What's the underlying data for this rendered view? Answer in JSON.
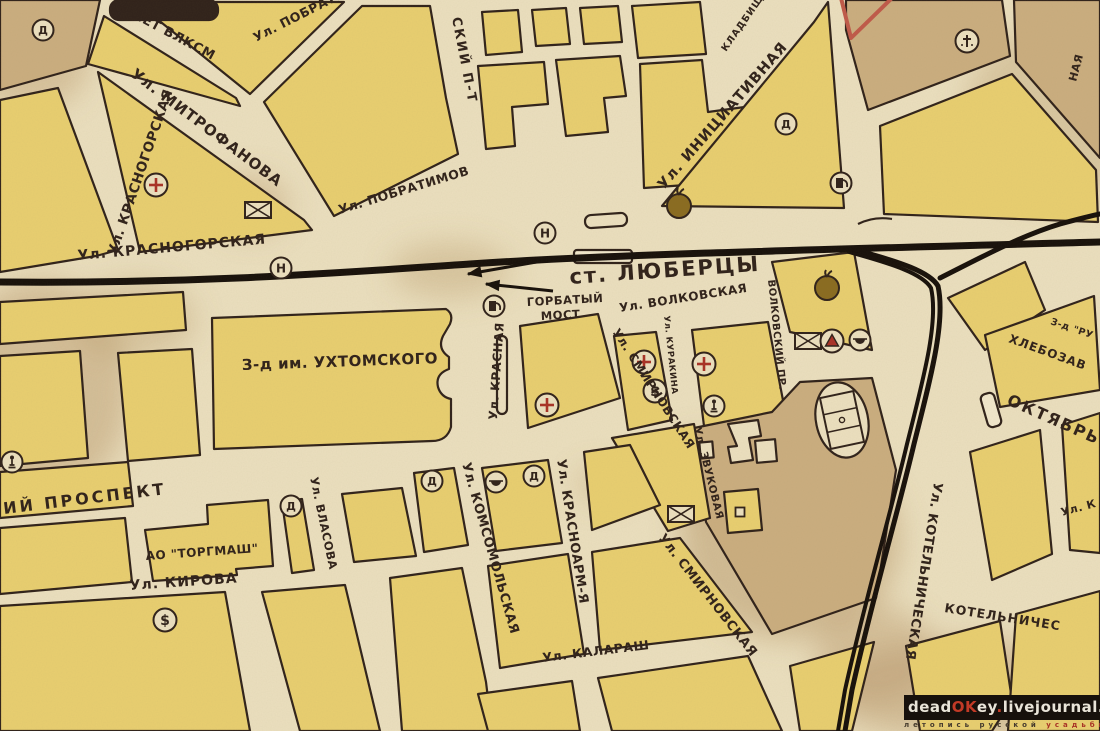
{
  "map": {
    "palette": {
      "paper": "#ece0bf",
      "paper_light": "#f2e8cc",
      "yellow": "#e9cf70",
      "tan": "#cbae7f",
      "ink": "#30221a",
      "rail": "#17100a",
      "red": "#a93226",
      "red_line": "#c05a49",
      "tomato": "#8a6c20",
      "stain": "#b89768"
    },
    "stains": [
      {
        "cx": 40,
        "cy": 390,
        "rx": 90,
        "ry": 110,
        "o": 0.45
      },
      {
        "cx": 250,
        "cy": 205,
        "rx": 38,
        "ry": 30,
        "o": 0.4
      },
      {
        "cx": 450,
        "cy": 270,
        "rx": 60,
        "ry": 28,
        "o": 0.35
      },
      {
        "cx": 790,
        "cy": 540,
        "rx": 110,
        "ry": 100,
        "o": 0.5
      },
      {
        "cx": 700,
        "cy": 475,
        "rx": 35,
        "ry": 40,
        "o": 0.4
      },
      {
        "cx": 960,
        "cy": 690,
        "rx": 140,
        "ry": 50,
        "o": 0.45
      },
      {
        "cx": 1055,
        "cy": 115,
        "rx": 90,
        "ry": 90,
        "o": 0.35
      },
      {
        "cx": 600,
        "cy": 485,
        "rx": 25,
        "ry": 18,
        "o": 0.3
      },
      {
        "cx": 135,
        "cy": 320,
        "rx": 60,
        "ry": 40,
        "o": 0.35
      },
      {
        "cx": 30,
        "cy": 60,
        "rx": 60,
        "ry": 50,
        "o": 0.4
      },
      {
        "cx": 875,
        "cy": 655,
        "rx": 60,
        "ry": 50,
        "o": 0.4
      }
    ],
    "blocks": [
      {
        "name": "corner-block",
        "points": "0,0 100,0 86,66 0,90",
        "fill": "tan"
      },
      {
        "name": "west-sliver-block",
        "points": "0,100 58,88 118,250 96,256 0,272",
        "fill": "yellow"
      },
      {
        "name": "mitrofanova-south-block",
        "points": "98,72 304,220 312,230 140,252",
        "fill": "yellow"
      },
      {
        "name": "vlksm-mitrofanova-block",
        "points": "104,16 236,98 240,106 88,64",
        "fill": "yellow"
      },
      {
        "name": "top-triangle-block",
        "points": "136,2 344,2 250,94",
        "fill": "yellow"
      },
      {
        "name": "pobratimov-east-block",
        "points": "264,102 362,6 430,6 446,98 458,154 334,216",
        "fill": "yellow"
      },
      {
        "name": "small-square-block",
        "points": "482,12 518,10 522,52 486,55",
        "fill": "yellow"
      },
      {
        "name": "small-square-block",
        "points": "532,10 566,8 570,44 536,46",
        "fill": "yellow"
      },
      {
        "name": "small-square-block",
        "points": "580,8 618,6 622,42 584,44",
        "fill": "yellow"
      },
      {
        "name": "zigzag-block-west",
        "points": "478,66 544,62 548,104 512,107 515,146 486,149",
        "fill": "yellow"
      },
      {
        "name": "zigzag-block-mid",
        "points": "556,60 620,56 626,96 604,98 608,132 566,136",
        "fill": "yellow"
      },
      {
        "name": "north-small-block",
        "points": "632,6 700,2 706,54 638,58",
        "fill": "yellow"
      },
      {
        "name": "center-north-block",
        "points": "640,64 702,60 708,112 752,106 700,184 644,188",
        "fill": "yellow"
      },
      {
        "name": "iniciativnaya-east-block",
        "points": "814,22 828,2 844,208 662,206",
        "fill": "yellow"
      },
      {
        "name": "cemetery-block",
        "points": "846,0 1002,0 1010,56 868,110 846,30",
        "fill": "tan"
      },
      {
        "name": "top-right-block",
        "points": "1014,0 1100,0 1100,158 1016,62",
        "fill": "tan"
      },
      {
        "name": "northeast-block",
        "points": "880,126 1012,74 1096,170 1098,222 884,214",
        "fill": "yellow"
      },
      {
        "name": "west-block",
        "points": "0,302 183,292 186,330 0,344",
        "fill": "yellow"
      },
      {
        "name": "west-block",
        "points": "0,356 80,351 88,458 0,466",
        "fill": "yellow"
      },
      {
        "name": "west-block",
        "points": "118,353 192,349 200,455 128,461",
        "fill": "yellow"
      },
      {
        "name": "west-prospekt-block",
        "points": "0,472 128,462 133,506 0,518",
        "fill": "yellow"
      },
      {
        "name": "red-cross-block",
        "points": "520,326 598,314 620,398 528,428",
        "fill": "yellow"
      },
      {
        "name": "kurakina-west-block",
        "points": "614,336 656,332 672,420 628,430",
        "fill": "yellow"
      },
      {
        "name": "kurakina-east-block",
        "points": "692,330 768,322 786,416 704,426",
        "fill": "yellow"
      },
      {
        "name": "volkovskaya-north-block",
        "points": "772,262 854,252 872,350 790,332",
        "fill": "yellow"
      },
      {
        "name": "rail-wedge-block",
        "points": "948,298 1025,262 1045,310 985,350",
        "fill": "yellow"
      },
      {
        "name": "bread-factory-block",
        "points": "985,335 1094,296 1100,390 1000,407",
        "fill": "yellow"
      },
      {
        "name": "southeast-block",
        "points": "970,452 1040,430 1052,554 992,580",
        "fill": "yellow"
      },
      {
        "name": "southeast-block",
        "points": "1062,425 1100,413 1100,553 1070,550",
        "fill": "yellow"
      },
      {
        "name": "bottom-right-block",
        "points": "906,646 1000,621 1012,700 992,731 920,731",
        "fill": "yellow"
      },
      {
        "name": "bottom-right-block",
        "points": "1016,614 1100,591 1100,731 1008,731",
        "fill": "yellow"
      },
      {
        "name": "stadium-area",
        "points": "694,428 772,412 800,382 872,378 896,470 876,598 772,634 706,522",
        "fill": "tan"
      },
      {
        "name": "south-block",
        "points": "790,666 874,642 852,731 800,731",
        "fill": "yellow"
      },
      {
        "name": "kirova-south-block",
        "points": "0,606 225,592 250,731 0,731",
        "fill": "yellow"
      },
      {
        "name": "kirova-south-block",
        "points": "262,592 345,585 380,731 300,731",
        "fill": "yellow"
      },
      {
        "name": "kirova-south-block",
        "points": "390,578 462,568 486,682 492,731 402,731",
        "fill": "yellow"
      },
      {
        "name": "kalarash-south-block",
        "points": "478,694 572,681 580,731 488,731",
        "fill": "yellow"
      },
      {
        "name": "kalarash-south-block",
        "points": "598,678 748,656 782,731 612,731",
        "fill": "yellow"
      },
      {
        "name": "smirnovskaya-west-block",
        "points": "592,552 680,538 752,632 600,650",
        "fill": "yellow"
      },
      {
        "name": "kirova-north-block",
        "points": "488,566 568,554 584,654 500,668",
        "fill": "yellow"
      },
      {
        "name": "torgmash-row-west-block",
        "points": "0,528 125,518 132,582 0,594",
        "fill": "yellow"
      },
      {
        "name": "torgmash-east-block",
        "points": "282,502 302,499 314,570 292,573",
        "fill": "yellow"
      },
      {
        "name": "vlasova-east-block",
        "points": "342,494 402,488 416,556 354,562",
        "fill": "yellow"
      },
      {
        "name": "prospekt-south-block",
        "points": "414,473 454,468 468,545 424,552",
        "fill": "yellow"
      },
      {
        "name": "icons-block",
        "points": "482,468 548,460 562,543 496,551",
        "fill": "yellow"
      },
      {
        "name": "zvukovaya-small-block",
        "points": "724,492 758,489 762,530 728,533",
        "fill": "yellow"
      },
      {
        "name": "smirnovskaya-east-block",
        "points": "612,438 694,424 710,518 668,531",
        "fill": "yellow"
      },
      {
        "name": "smirnovskaya-north-block",
        "points": "584,452 630,445 660,505 592,530",
        "fill": "yellow"
      }
    ],
    "shapes": [
      {
        "type": "path",
        "name": "ukhtomsky-factory-block",
        "d": "M212,318 L446,309 Q454,314 450,324 L443,336 Q437,349 449,357 L449,369 Q435,374 438,387 Q441,397 451,399 L451,427 Q447,441 432,441 L214,449 Z",
        "fill": "yellow"
      },
      {
        "type": "path",
        "name": "torgmash-factory-block",
        "d": "M145,530 L208,524 L207,505 L268,500 L273,566 L236,569 L237,575 L153,581 Z",
        "fill": "yellow"
      },
      {
        "type": "rect",
        "name": "dark-building",
        "x": 110,
        "y": 0,
        "w": 108,
        "h": 20,
        "rx": 9,
        "fill": "ink"
      },
      {
        "type": "rect",
        "name": "station-platform",
        "x": 574,
        "y": 250,
        "w": 58,
        "h": 13,
        "rx": 3,
        "fill": "paper_light"
      },
      {
        "type": "rect",
        "name": "station-building",
        "x": 585,
        "y": 214,
        "w": 42,
        "h": 13,
        "rx": 6,
        "rot": -4,
        "fill": "paper"
      },
      {
        "type": "rect",
        "name": "platform-marker",
        "x": 984,
        "y": 393,
        "w": 14,
        "h": 34,
        "rx": 5,
        "rot": -16,
        "fill": "paper_light"
      },
      {
        "type": "rect",
        "name": "narrow-strip-building",
        "x": 497,
        "y": 336,
        "w": 10,
        "h": 78,
        "rx": 5,
        "fill": "paper"
      },
      {
        "type": "path",
        "name": "canopy-mark",
        "d": "M858,224 q16,-8 34,-5",
        "fill": "none"
      },
      {
        "type": "path",
        "name": "l-building",
        "d": "M728,424 l30,-4 3,16 -12,2 4,22 -22,3 -3,-16 9,-1 z",
        "fill": "paper"
      },
      {
        "type": "rect",
        "name": "building",
        "x": 756,
        "y": 440,
        "w": 20,
        "h": 22,
        "rot": -5,
        "fill": "paper"
      },
      {
        "type": "rect",
        "name": "building",
        "x": 700,
        "y": 442,
        "w": 13,
        "h": 16,
        "rot": -5,
        "fill": "paper"
      },
      {
        "type": "path",
        "name": "red-boundary-line",
        "d": "M841,-2 L851,38 L892,-2",
        "fill": "none",
        "stroke": "red_line",
        "sw": 4
      }
    ],
    "railways": [
      {
        "name": "main-railway",
        "d": "M0,282 C200,284 350,272 470,264 C600,255 800,250 1100,242",
        "w": 7
      },
      {
        "name": "branch-railway",
        "d": "M856,250 C900,262 930,272 938,286 C946,322 930,380 914,444 C898,512 872,600 852,690 L845,731",
        "w": 5
      },
      {
        "name": "branch-railway-track2",
        "d": "M849,252 C893,264 923,274 931,288 C939,322 923,380 907,444 C891,512 865,600 845,690 L838,731",
        "w": 4
      },
      {
        "name": "railway-curve",
        "d": "M940,278 C980,258 1020,236 1060,224 C1075,220 1090,216 1100,214",
        "w": 5
      }
    ],
    "arrows": [
      {
        "x1": 548,
        "y1": 260,
        "x2": 468,
        "y2": 274
      },
      {
        "x1": 553,
        "y1": 291,
        "x2": 486,
        "y2": 284
      }
    ],
    "icons": [
      {
        "t": "d",
        "x": 43,
        "y": 30
      },
      {
        "t": "cross",
        "x": 156,
        "y": 185
      },
      {
        "t": "mail",
        "x": 258,
        "y": 210
      },
      {
        "t": "h",
        "x": 281,
        "y": 268
      },
      {
        "t": "h",
        "x": 545,
        "y": 233
      },
      {
        "t": "tomato",
        "x": 679,
        "y": 206
      },
      {
        "t": "cem",
        "x": 967,
        "y": 41
      },
      {
        "t": "d",
        "x": 786,
        "y": 124
      },
      {
        "t": "fuel",
        "x": 841,
        "y": 183
      },
      {
        "t": "fuel",
        "x": 494,
        "y": 306
      },
      {
        "t": "cross",
        "x": 547,
        "y": 405
      },
      {
        "t": "cross",
        "x": 644,
        "y": 362
      },
      {
        "t": "bank",
        "x": 655,
        "y": 391
      },
      {
        "t": "cross",
        "x": 704,
        "y": 364
      },
      {
        "t": "mail",
        "x": 808,
        "y": 341
      },
      {
        "t": "warn",
        "x": 832,
        "y": 341
      },
      {
        "t": "cafe",
        "x": 860,
        "y": 340
      },
      {
        "t": "tomato",
        "x": 827,
        "y": 288
      },
      {
        "t": "man",
        "x": 714,
        "y": 406
      },
      {
        "t": "d",
        "x": 432,
        "y": 481
      },
      {
        "t": "cafe",
        "x": 496,
        "y": 482
      },
      {
        "t": "d",
        "x": 534,
        "y": 476
      },
      {
        "t": "mail",
        "x": 681,
        "y": 514
      },
      {
        "t": "d",
        "x": 291,
        "y": 506
      },
      {
        "t": "bank",
        "x": 165,
        "y": 620
      },
      {
        "t": "man",
        "x": 12,
        "y": 462
      },
      {
        "t": "sq",
        "x": 740,
        "y": 512
      },
      {
        "t": "stad",
        "x": 842,
        "y": 420,
        "r": -12
      }
    ],
    "labels": [
      {
        "name": "street-label-50-let-vlksm",
        "t": "0-ЛЕТ ВЛКСМ",
        "x": 118,
        "y": 10,
        "r": 28,
        "s": 13
      },
      {
        "name": "street-label-pobratimov-1",
        "t": "Ул. ПОБРАТИМОВ",
        "x": 256,
        "y": 42,
        "r": -27,
        "s": 12.5
      },
      {
        "name": "street-label-mitrofanova",
        "t": "Ул. МИТРОФАНОВА",
        "x": 130,
        "y": 76,
        "r": 37,
        "s": 15,
        "ls": 1
      },
      {
        "name": "street-label-krasnogorskaya-vert",
        "t": "Ул. КРАСНОГОРСКАЯ",
        "x": 116,
        "y": 256,
        "r": -71,
        "s": 13.5
      },
      {
        "name": "street-label-sky-prospekt",
        "t": "СКИЙ П-Т",
        "x": 452,
        "y": 18,
        "r": 79,
        "s": 13,
        "ls": 2
      },
      {
        "name": "street-label-pobratimov-2",
        "t": "Ул. ПОБРАТИМОВ",
        "x": 340,
        "y": 214,
        "r": -17,
        "s": 12.5
      },
      {
        "name": "street-label-krasnogorskaya",
        "t": "Ул. КРАСНОГОРСКАЯ",
        "x": 78,
        "y": 260,
        "r": -5,
        "s": 14,
        "ls": 1
      },
      {
        "name": "street-label-iniciativnaya",
        "t": "Ул. ИНИЦИАТИВНАЯ",
        "x": 664,
        "y": 190,
        "r": -49,
        "s": 14.5,
        "ls": 1
      },
      {
        "name": "cemetery-label",
        "t": "КЛАДБИЩ",
        "x": 726,
        "y": 52,
        "r": -55,
        "s": 9.5,
        "ls": 1
      },
      {
        "name": "street-label-partial-naya",
        "t": "НАЯ",
        "x": 1076,
        "y": 82,
        "r": -75,
        "s": 11
      },
      {
        "name": "station-label",
        "t": "ст. ЛЮБЕРЦЫ",
        "x": 570,
        "y": 284,
        "r": -4,
        "s": 21,
        "ls": 2
      },
      {
        "name": "bridge-label-line1",
        "t": "ГОРБАТЫЙ",
        "x": 527,
        "y": 306,
        "r": -3,
        "s": 11.5
      },
      {
        "name": "bridge-label-line2",
        "t": "МОСТ",
        "x": 541,
        "y": 320,
        "r": -3,
        "s": 11.5
      },
      {
        "name": "street-label-volkovskaya",
        "t": "Ул. ВОЛКОВСКАЯ",
        "x": 620,
        "y": 312,
        "r": -9,
        "s": 12
      },
      {
        "name": "street-label-volkovsky-pr",
        "t": "ВОЛКОВСКИЙ ПР.",
        "x": 768,
        "y": 280,
        "r": 84,
        "s": 10
      },
      {
        "name": "street-label-kurakina",
        "t": "Ул. КУРАКИНА",
        "x": 664,
        "y": 316,
        "r": 84,
        "s": 8.5
      },
      {
        "name": "street-label-krasnaya",
        "t": "Ул. КРАСНАЯ",
        "x": 497,
        "y": 420,
        "r": -86,
        "s": 12
      },
      {
        "name": "factory-label-ukhtomsky",
        "t": "З-д им. УХТОМСКОГО",
        "x": 242,
        "y": 370,
        "r": -2,
        "s": 15
      },
      {
        "name": "street-label-smirnovskaya-1",
        "t": "Ул. СМИРНОВСКАЯ",
        "x": 612,
        "y": 332,
        "r": 57,
        "s": 12
      },
      {
        "name": "street-label-smirnovskaya-2",
        "t": "Ул. СМИРНОВСКАЯ",
        "x": 658,
        "y": 538,
        "r": 52,
        "s": 13
      },
      {
        "name": "street-label-zvukovaya",
        "t": "Ул. ЗВУКОВАЯ",
        "x": 694,
        "y": 428,
        "r": 76,
        "s": 10.5
      },
      {
        "name": "street-label-prospekt",
        "t": "ИЙ ПРОСПЕКТ",
        "x": 4,
        "y": 514,
        "r": -7,
        "s": 16,
        "ls": 3
      },
      {
        "name": "factory-label-torgmash",
        "t": "АО \"ТОРГМАШ\"",
        "x": 146,
        "y": 560,
        "r": -4,
        "s": 12
      },
      {
        "name": "street-label-kirova",
        "t": "Ул. КИРОВА",
        "x": 130,
        "y": 590,
        "r": -4,
        "s": 14,
        "ls": 1
      },
      {
        "name": "street-label-vlasova",
        "t": "Ул. ВЛАСОВА",
        "x": 310,
        "y": 478,
        "r": 78,
        "s": 11.5
      },
      {
        "name": "street-label-komsomolskaya",
        "t": "Ул. КОМСОМОЛЬСКАЯ",
        "x": 462,
        "y": 464,
        "r": 74,
        "s": 13
      },
      {
        "name": "street-label-krasnoarmeyskaya",
        "t": "Ул. КРАСНОАРМ-Я",
        "x": 557,
        "y": 460,
        "r": 81,
        "s": 13
      },
      {
        "name": "street-label-kalarash",
        "t": "Ул. КАЛАРАШ",
        "x": 543,
        "y": 662,
        "r": -7,
        "s": 12.5
      },
      {
        "name": "street-label-kotelnicheskaya",
        "t": "Ул. КОТЕЛЬНИЧЕСКАЯ",
        "x": 934,
        "y": 482,
        "r": 99,
        "s": 13
      },
      {
        "name": "street-label-kotelniches",
        "t": "КОТЕЛЬНИЧЕС",
        "x": 944,
        "y": 612,
        "r": 9,
        "s": 12.5,
        "ls": 1
      },
      {
        "name": "street-label-oktyabr",
        "t": "ОКТЯБРЬ",
        "x": 1006,
        "y": 404,
        "r": 24,
        "s": 16,
        "ls": 2
      },
      {
        "name": "factory-label-hlebozavod",
        "t": "ХЛЕБОЗАВ",
        "x": 1008,
        "y": 342,
        "r": 20,
        "s": 12,
        "ls": 1
      },
      {
        "name": "factory-label-zd-ru",
        "t": "З-д \"РУ",
        "x": 1050,
        "y": 324,
        "r": 19,
        "s": 9.5
      },
      {
        "name": "street-label-partial-right",
        "t": "Ул. К",
        "x": 1062,
        "y": 516,
        "r": -15,
        "s": 11
      }
    ]
  },
  "watermark": {
    "dead": "dead",
    "ok": "OK",
    "ey": "ey",
    "dot1": ".",
    "livejournal": "livejournal",
    "dot2": ".",
    "com": "com",
    "sub_left": "летопись русской",
    "sub_right": "усадьбы"
  }
}
